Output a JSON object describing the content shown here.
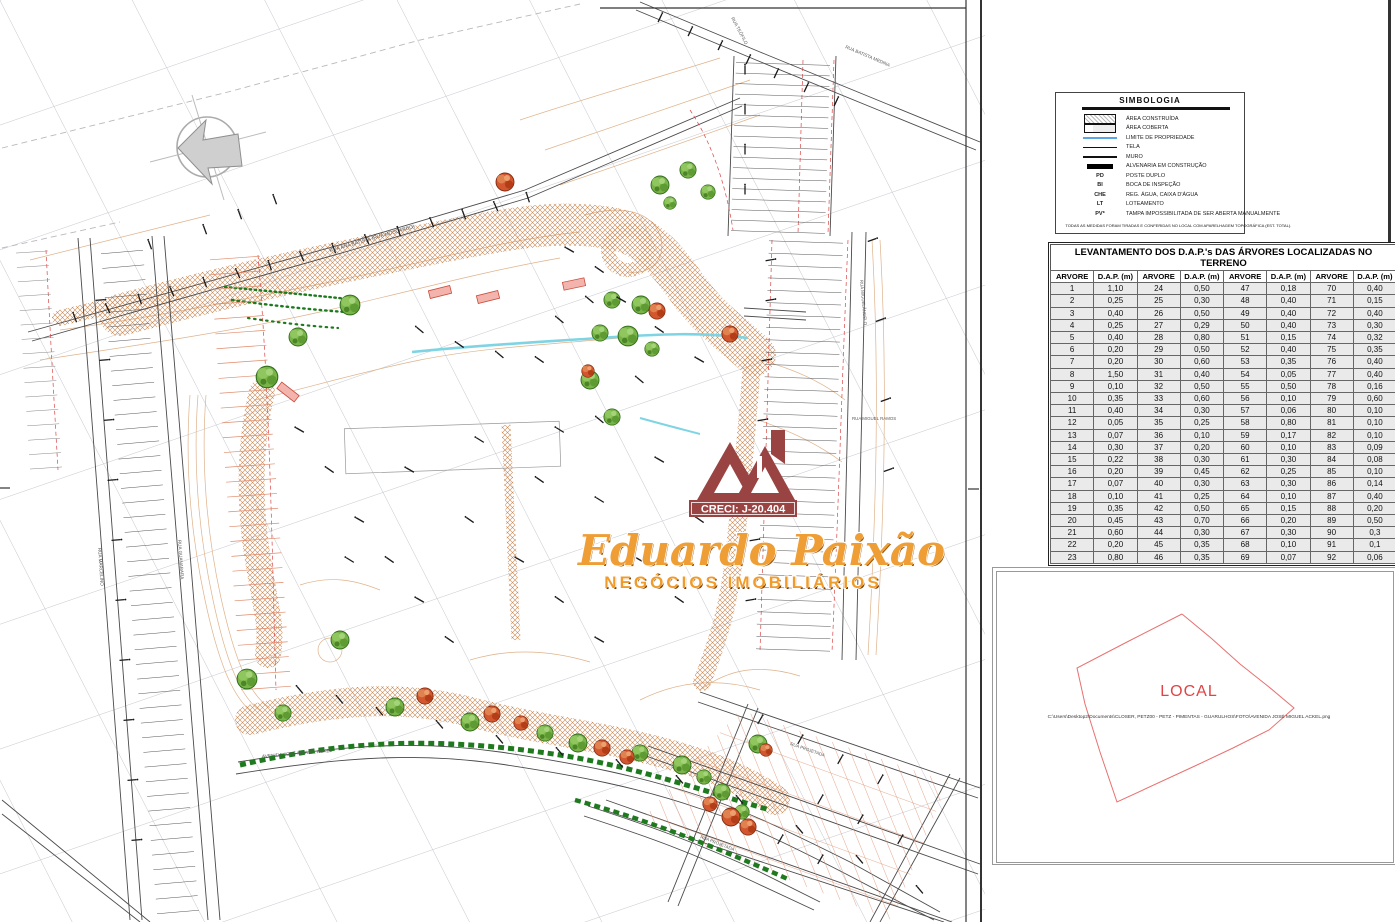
{
  "logo": {
    "creci": "CRECI: J-20.404",
    "name": "Eduardo Paixão",
    "tagline": "NEGÓCIOS IMOBILIÁRIOS",
    "colors": {
      "maroon": "#9a4343",
      "orange": "#ee9e35"
    }
  },
  "legend": {
    "title": "SIMBOLOGIA",
    "items": [
      {
        "symbol": "sw-hatch",
        "code": "",
        "label": "ÁREA CONSTRUÍDA"
      },
      {
        "symbol": "sw-cover",
        "code": "",
        "label": "ÁREA COBERTA"
      },
      {
        "symbol": "sw-blue",
        "code": "",
        "label": "LIMITE DE PROPRIEDADE"
      },
      {
        "symbol": "sw-thin",
        "code": "",
        "label": "TELA"
      },
      {
        "symbol": "sw-thick",
        "code": "",
        "label": "MURO"
      },
      {
        "symbol": "sw-solid",
        "code": "",
        "label": "ALVENARIA EM CONSTRUÇÃO"
      },
      {
        "symbol": "",
        "code": "PD",
        "label": "POSTE DUPLO"
      },
      {
        "symbol": "",
        "code": "BI",
        "label": "BOCA DE INSPEÇÃO"
      },
      {
        "symbol": "",
        "code": "CHE",
        "label": "REG. ÁGUA, CAIXA D'ÁGUA"
      },
      {
        "symbol": "",
        "code": "LT",
        "label": "LOTEAMENTO"
      },
      {
        "symbol": "",
        "code": "PV*",
        "label": "TAMPA IMPOSSIBILITADA DE SER ABERTA MANUALMENTE"
      }
    ],
    "footnote": "TODAS AS MEDIDAS FORAM TIRADAS E CONFERIDAS NO LOCAL COM APARELHAGEM TOPOGRÁFICA (EST. TOTAL)."
  },
  "dap_table": {
    "title": "LEVANTAMENTO DOS D.A.P.'s DAS ÁRVORES LOCALIZADAS NO TERRENO",
    "col_headers": [
      "ARVORE",
      "D.A.P. (m)",
      "ARVORE",
      "D.A.P. (m)",
      "ARVORE",
      "D.A.P. (m)",
      "ARVORE",
      "D.A.P. (m)"
    ],
    "rows": [
      [
        "1",
        "1,10",
        "24",
        "0,50",
        "47",
        "0,18",
        "70",
        "0,40"
      ],
      [
        "2",
        "0,25",
        "25",
        "0,30",
        "48",
        "0,40",
        "71",
        "0,15"
      ],
      [
        "3",
        "0,40",
        "26",
        "0,50",
        "49",
        "0,40",
        "72",
        "0,40"
      ],
      [
        "4",
        "0,25",
        "27",
        "0,29",
        "50",
        "0,40",
        "73",
        "0,30"
      ],
      [
        "5",
        "0,40",
        "28",
        "0,80",
        "51",
        "0,15",
        "74",
        "0,32"
      ],
      [
        "6",
        "0,20",
        "29",
        "0,50",
        "52",
        "0,40",
        "75",
        "0,35"
      ],
      [
        "7",
        "0,20",
        "30",
        "0,60",
        "53",
        "0,35",
        "76",
        "0,40"
      ],
      [
        "8",
        "1,50",
        "31",
        "0,40",
        "54",
        "0,05",
        "77",
        "0,40"
      ],
      [
        "9",
        "0,10",
        "32",
        "0,50",
        "55",
        "0,50",
        "78",
        "0,16"
      ],
      [
        "10",
        "0,35",
        "33",
        "0,60",
        "56",
        "0,10",
        "79",
        "0,60"
      ],
      [
        "11",
        "0,40",
        "34",
        "0,30",
        "57",
        "0,06",
        "80",
        "0,10"
      ],
      [
        "12",
        "0,05",
        "35",
        "0,25",
        "58",
        "0,80",
        "81",
        "0,10"
      ],
      [
        "13",
        "0,07",
        "36",
        "0,10",
        "59",
        "0,17",
        "82",
        "0,10"
      ],
      [
        "14",
        "0,30",
        "37",
        "0,20",
        "60",
        "0,10",
        "83",
        "0,09"
      ],
      [
        "15",
        "0,22",
        "38",
        "0,30",
        "61",
        "0,30",
        "84",
        "0,08"
      ],
      [
        "16",
        "0,20",
        "39",
        "0,45",
        "62",
        "0,25",
        "85",
        "0,10"
      ],
      [
        "17",
        "0,07",
        "40",
        "0,30",
        "63",
        "0,30",
        "86",
        "0,14"
      ],
      [
        "18",
        "0,10",
        "41",
        "0,25",
        "64",
        "0,10",
        "87",
        "0,40"
      ],
      [
        "19",
        "0,35",
        "42",
        "0,50",
        "65",
        "0,15",
        "88",
        "0,20"
      ],
      [
        "20",
        "0,45",
        "43",
        "0,70",
        "66",
        "0,20",
        "89",
        "0,50"
      ],
      [
        "21",
        "0,60",
        "44",
        "0,30",
        "67",
        "0,30",
        "90",
        "0,3"
      ],
      [
        "22",
        "0,20",
        "45",
        "0,35",
        "68",
        "0,10",
        "91",
        "0,1"
      ],
      [
        "23",
        "0,80",
        "46",
        "0,35",
        "69",
        "0,07",
        "92",
        "0,06"
      ]
    ]
  },
  "local_inset": {
    "title": "LOCAL",
    "path_text": "C:\\Users\\Desktop2\\Documents\\CLOSER, PETZ00 - PETZ - PIMENTAS - GUARULHOS\\FOTO\\AVENIDA JOSÉ MIGUEL ACKEL.png"
  },
  "plan": {
    "streets": {
      "top_road": "RUA ANA BATISTA (RUA MOSCARDO)",
      "top_steep": "RUA TEÓFILO",
      "top_right": "RUA BATISTA MEDINA",
      "right_mid": "RUA MIGUEL RAMOS",
      "right_col": "RUA MIGUELÂNGELO",
      "avenue": "AVENIDA JOSÉ MIGUEL ACKEL",
      "left_road1": "RUA MARCELINO",
      "left_road2": "RUA GUANABARA",
      "br_street1": "RUA PROJETADA",
      "br_street2": "RUA PROJETADA"
    },
    "colors": {
      "grid": "#c6c8ce",
      "contour": "#dfb28a",
      "hatch": "#c9854f",
      "lot_salmon": "#e08a6a",
      "red_dash": "#dd4444",
      "stream": "#7fd4e4",
      "hedge": "#1f7a1f",
      "tree_green": "#79b449",
      "tree_orange": "#d2562e"
    },
    "trees": {
      "green": [
        [
          660,
          185,
          1
        ],
        [
          688,
          170,
          0.9
        ],
        [
          708,
          192,
          0.8
        ],
        [
          670,
          203,
          0.7
        ],
        [
          612,
          300,
          0.9
        ],
        [
          641,
          305,
          1
        ],
        [
          600,
          333,
          0.9
        ],
        [
          628,
          336,
          1.1
        ],
        [
          652,
          349,
          0.8
        ],
        [
          590,
          380,
          1
        ],
        [
          612,
          417,
          0.9
        ],
        [
          350,
          305,
          1.1
        ],
        [
          298,
          337,
          1
        ],
        [
          267,
          377,
          1.2
        ],
        [
          340,
          640,
          1
        ],
        [
          247,
          679,
          1.1
        ],
        [
          283,
          713,
          0.9
        ],
        [
          395,
          707,
          1
        ],
        [
          470,
          722,
          1
        ],
        [
          545,
          733,
          0.9
        ],
        [
          578,
          743,
          1
        ],
        [
          640,
          753,
          0.9
        ],
        [
          682,
          765,
          1
        ],
        [
          704,
          777,
          0.8
        ],
        [
          758,
          744,
          1
        ],
        [
          722,
          792,
          0.9
        ],
        [
          742,
          812,
          0.8
        ]
      ],
      "orange": [
        [
          505,
          182,
          1
        ],
        [
          657,
          311,
          0.9
        ],
        [
          730,
          334,
          0.9
        ],
        [
          588,
          371,
          0.7
        ],
        [
          425,
          696,
          0.9
        ],
        [
          492,
          714,
          0.9
        ],
        [
          521,
          723,
          0.8
        ],
        [
          602,
          748,
          0.9
        ],
        [
          627,
          757,
          0.8
        ],
        [
          731,
          817,
          1
        ],
        [
          748,
          827,
          0.9
        ],
        [
          710,
          804,
          0.8
        ],
        [
          766,
          750,
          0.7
        ]
      ]
    },
    "survey_ticks": [
      [
        75,
        318,
        -20
      ],
      [
        108,
        309,
        -25
      ],
      [
        140,
        300,
        -18
      ],
      [
        172,
        292,
        -22
      ],
      [
        205,
        283,
        -20
      ],
      [
        238,
        274,
        -24
      ],
      [
        270,
        266,
        -18
      ],
      [
        302,
        257,
        -22
      ],
      [
        334,
        249,
        -20
      ],
      [
        367,
        240,
        -24
      ],
      [
        399,
        232,
        -18
      ],
      [
        432,
        223,
        -22
      ],
      [
        464,
        215,
        -20
      ],
      [
        496,
        207,
        -24
      ],
      [
        528,
        198,
        -18
      ],
      [
        660,
        18,
        25
      ],
      [
        690,
        32,
        25
      ],
      [
        720,
        46,
        25
      ],
      [
        748,
        60,
        25
      ],
      [
        776,
        74,
        25
      ],
      [
        806,
        88,
        25
      ],
      [
        836,
        102,
        25
      ],
      [
        570,
        250,
        -60
      ],
      [
        600,
        270,
        -55
      ],
      [
        622,
        300,
        -60
      ],
      [
        660,
        330,
        -55
      ],
      [
        700,
        360,
        -60
      ],
      [
        420,
        330,
        -50
      ],
      [
        460,
        345,
        -55
      ],
      [
        500,
        355,
        -50
      ],
      [
        540,
        360,
        -55
      ],
      [
        300,
        430,
        -60
      ],
      [
        330,
        470,
        -55
      ],
      [
        360,
        520,
        -60
      ],
      [
        390,
        560,
        -55
      ],
      [
        420,
        600,
        -60
      ],
      [
        450,
        640,
        -55
      ],
      [
        350,
        560,
        -58
      ],
      [
        410,
        470,
        -60
      ],
      [
        470,
        520,
        -55
      ],
      [
        520,
        560,
        -60
      ],
      [
        560,
        600,
        -55
      ],
      [
        600,
        640,
        -60
      ],
      [
        480,
        440,
        -58
      ],
      [
        540,
        480,
        -55
      ],
      [
        640,
        560,
        -60
      ],
      [
        680,
        600,
        -55
      ],
      [
        600,
        500,
        -58
      ],
      [
        660,
        460,
        -60
      ],
      [
        700,
        520,
        -55
      ],
      [
        560,
        430,
        -58
      ],
      [
        300,
        690,
        -40
      ],
      [
        340,
        700,
        -40
      ],
      [
        380,
        712,
        -40
      ],
      [
        440,
        725,
        -40
      ],
      [
        500,
        740,
        -40
      ],
      [
        560,
        752,
        -40
      ],
      [
        620,
        764,
        -40
      ],
      [
        680,
        780,
        -40
      ],
      [
        740,
        800,
        -40
      ],
      [
        800,
        830,
        -40
      ],
      [
        860,
        860,
        -40
      ],
      [
        920,
        890,
        -40
      ],
      [
        760,
        720,
        30
      ],
      [
        800,
        740,
        30
      ],
      [
        840,
        760,
        30
      ],
      [
        880,
        780,
        30
      ],
      [
        820,
        800,
        30
      ],
      [
        860,
        820,
        30
      ],
      [
        900,
        840,
        30
      ],
      [
        780,
        840,
        30
      ],
      [
        820,
        860,
        30
      ],
      [
        770,
        260,
        80
      ],
      [
        770,
        300,
        80
      ],
      [
        766,
        360,
        80
      ],
      [
        762,
        420,
        80
      ],
      [
        758,
        480,
        80
      ],
      [
        754,
        540,
        80
      ],
      [
        750,
        600,
        80
      ],
      [
        100,
        300,
        85
      ],
      [
        104,
        360,
        85
      ],
      [
        108,
        420,
        85
      ],
      [
        112,
        480,
        85
      ],
      [
        116,
        540,
        85
      ],
      [
        120,
        600,
        85
      ],
      [
        124,
        660,
        85
      ],
      [
        128,
        720,
        85
      ],
      [
        132,
        780,
        85
      ],
      [
        136,
        840,
        85
      ],
      [
        745,
        70,
        0
      ],
      [
        745,
        110,
        0
      ],
      [
        745,
        150,
        0
      ],
      [
        745,
        190,
        0
      ],
      [
        590,
        300,
        -50
      ],
      [
        560,
        320,
        -50
      ],
      [
        640,
        380,
        -50
      ],
      [
        600,
        420,
        -50
      ],
      [
        205,
        230,
        -20
      ],
      [
        240,
        215,
        -20
      ],
      [
        275,
        200,
        -20
      ],
      [
        150,
        245,
        -20
      ],
      [
        872,
        240,
        70
      ],
      [
        880,
        320,
        70
      ],
      [
        885,
        400,
        70
      ],
      [
        888,
        470,
        70
      ]
    ]
  }
}
